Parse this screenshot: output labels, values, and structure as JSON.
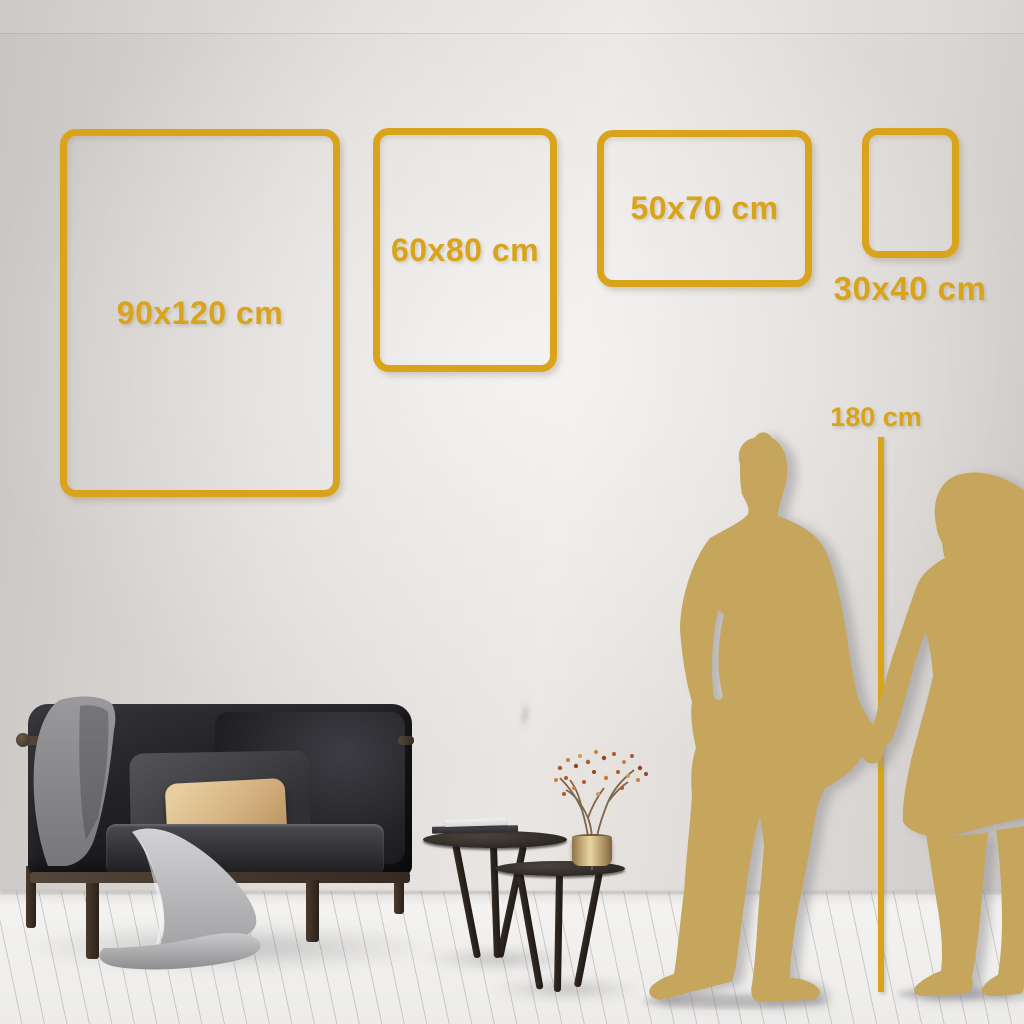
{
  "size_guide": {
    "frames": [
      {
        "id": "90x120",
        "label": "90x120 cm",
        "orientation": "portrait",
        "label_position": "inside"
      },
      {
        "id": "60x80",
        "label": "60x80 cm",
        "orientation": "portrait",
        "label_position": "inside"
      },
      {
        "id": "50x70",
        "label": "50x70 cm",
        "orientation": "landscape",
        "label_position": "inside"
      },
      {
        "id": "30x40",
        "label": "30x40 cm",
        "orientation": "portrait",
        "label_position": "below"
      }
    ],
    "height_marker_label": "180 cm"
  },
  "colors": {
    "accent_gold": "#D9A41C",
    "silhouette_gold": "#C6A65C",
    "wall_light": "#E9E6E3",
    "wall_dark": "#C8C4C1",
    "floor_light": "#F3F2F0",
    "sofa_dark": "#121214",
    "pillow_beige": "#D3AF7F",
    "blanket_gray": "#A9A9AB",
    "table_dark": "#2C2723",
    "vase_gold": "#BFA471",
    "berry_rust": "#B25A24"
  },
  "icons": {
    "man_silhouette_icon": "standing man outline, gold fill",
    "woman_silhouette_icon": "standing woman outline, gold fill"
  }
}
